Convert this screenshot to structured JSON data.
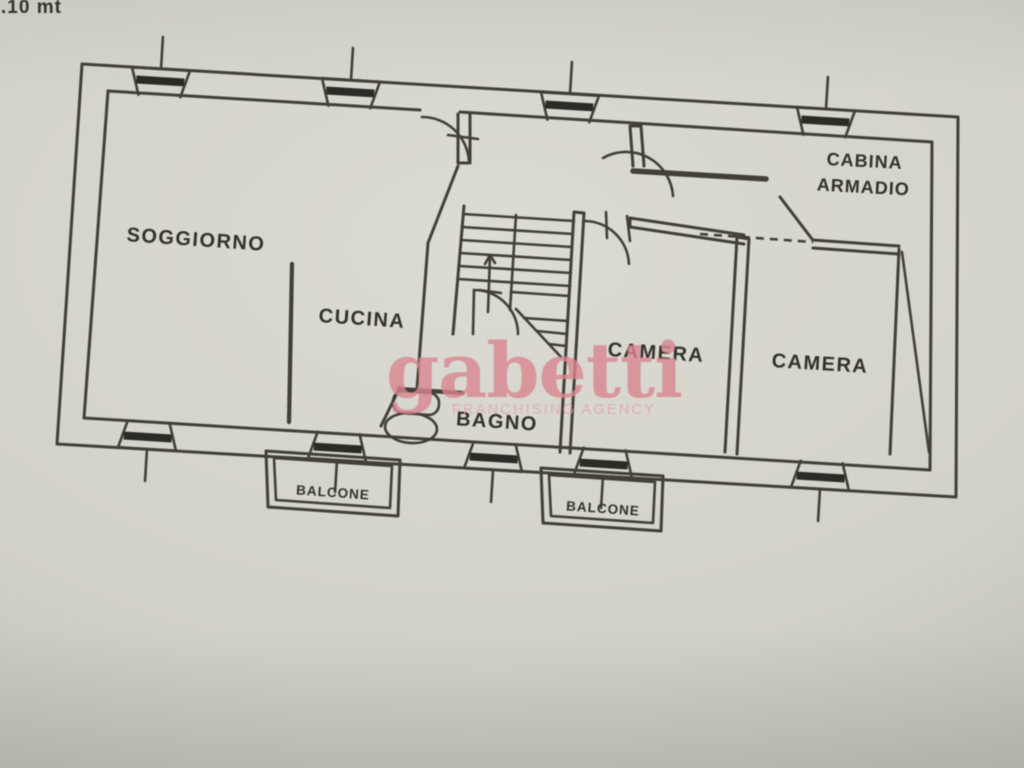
{
  "meta": {
    "scale_note": ".10 mt"
  },
  "watermark": {
    "brand": "gabetti",
    "tagline": "FRANCHISING AGENCY"
  },
  "rooms": [
    {
      "id": "soggiorno",
      "label": "SOGGIORNO"
    },
    {
      "id": "cucina",
      "label": "CUCINA"
    },
    {
      "id": "bagno",
      "label": "BAGNO"
    },
    {
      "id": "camera-1",
      "label": "CAMERA"
    },
    {
      "id": "camera-2",
      "label": "CAMERA"
    },
    {
      "id": "cabina-armadio",
      "label": "CABINA ARMADIO",
      "label_lines": [
        "CABINA",
        "ARMADIO"
      ]
    },
    {
      "id": "balcone-1",
      "label": "BALCONE"
    },
    {
      "id": "balcone-2",
      "label": "BALCONE"
    }
  ],
  "colors": {
    "ink": "#413f38",
    "ink_dark": "#2d2b26",
    "text": "#333129",
    "brand": "#d9868f",
    "tagline": "#e2a3a8"
  }
}
